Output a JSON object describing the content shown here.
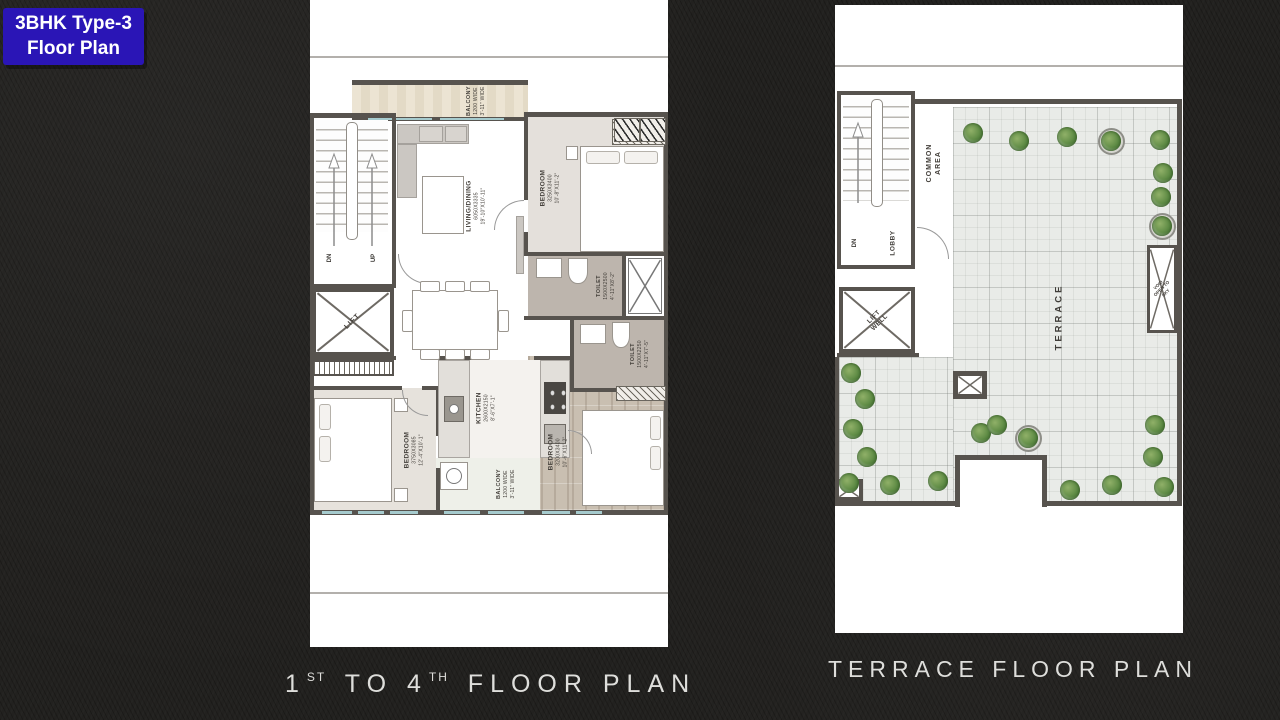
{
  "badge": {
    "line1": "3BHK Type-3",
    "line2": "Floor Plan"
  },
  "captions": {
    "left": {
      "n1": "1",
      "s1": "ST",
      "mid": " TO 4",
      "s2": "TH",
      "rest": " FLOOR PLAN"
    },
    "right": "TERRACE FLOOR PLAN"
  },
  "floor_plan": {
    "balcony_top": {
      "name": "BALCONY",
      "dim1": "1200 WIDE",
      "dim2": "3'-11\" WIDE"
    },
    "living": {
      "name": "LIVING/DINING",
      "dim1": "6050X3335",
      "dim2": "19'-10\"X10'-11\""
    },
    "bedroom_tr": {
      "name": "BEDROOM",
      "dim1": "3250X3400",
      "dim2": "10'-8\"X11'-2\""
    },
    "toilet_1": {
      "name": "TOILET",
      "dim1": "1500X2500",
      "dim2": "4'-11\"X8'-2\""
    },
    "toilet_2": {
      "name": "TOILET",
      "dim1": "1500X2250",
      "dim2": "4'-11\"X7'-5\""
    },
    "kitchen": {
      "name": "KITCHEN",
      "dim1": "2600X2150",
      "dim2": "8'-6\"X7'-1\""
    },
    "bedroom_bl": {
      "name": "BEDROOM",
      "dim1": "3750X3085",
      "dim2": "12'-4\"X10'-1\""
    },
    "balcony_b": {
      "name": "BALCONY",
      "dim1": "1200 WIDE",
      "dim2": "3'-11\" WIDE"
    },
    "bedroom_br": {
      "name": "BEDROOM",
      "dim1": "3200X3400",
      "dim2": "10'-6\"X11'-2\""
    },
    "dn": "DN",
    "up": "UP",
    "lift": "LIFT"
  },
  "terrace_plan": {
    "dn": "DN",
    "lobby": "LOBBY",
    "common_1": "COMMON",
    "common_2": "AREA",
    "lift_well_1": "LIFT",
    "lift_well_2": "WELL",
    "terrace": "TERRACE",
    "void_1": "VOID",
    "void_2": "OPEN TO",
    "void_3": "SKY"
  },
  "colors": {
    "badge_bg": "#2a15b6",
    "background": "#22211f",
    "caption_text": "#dededb",
    "wall": "#57534e",
    "window_glass": "#a6cbce",
    "plant_green": "#5d8a44",
    "tile_floor": "#e9ebe8"
  }
}
